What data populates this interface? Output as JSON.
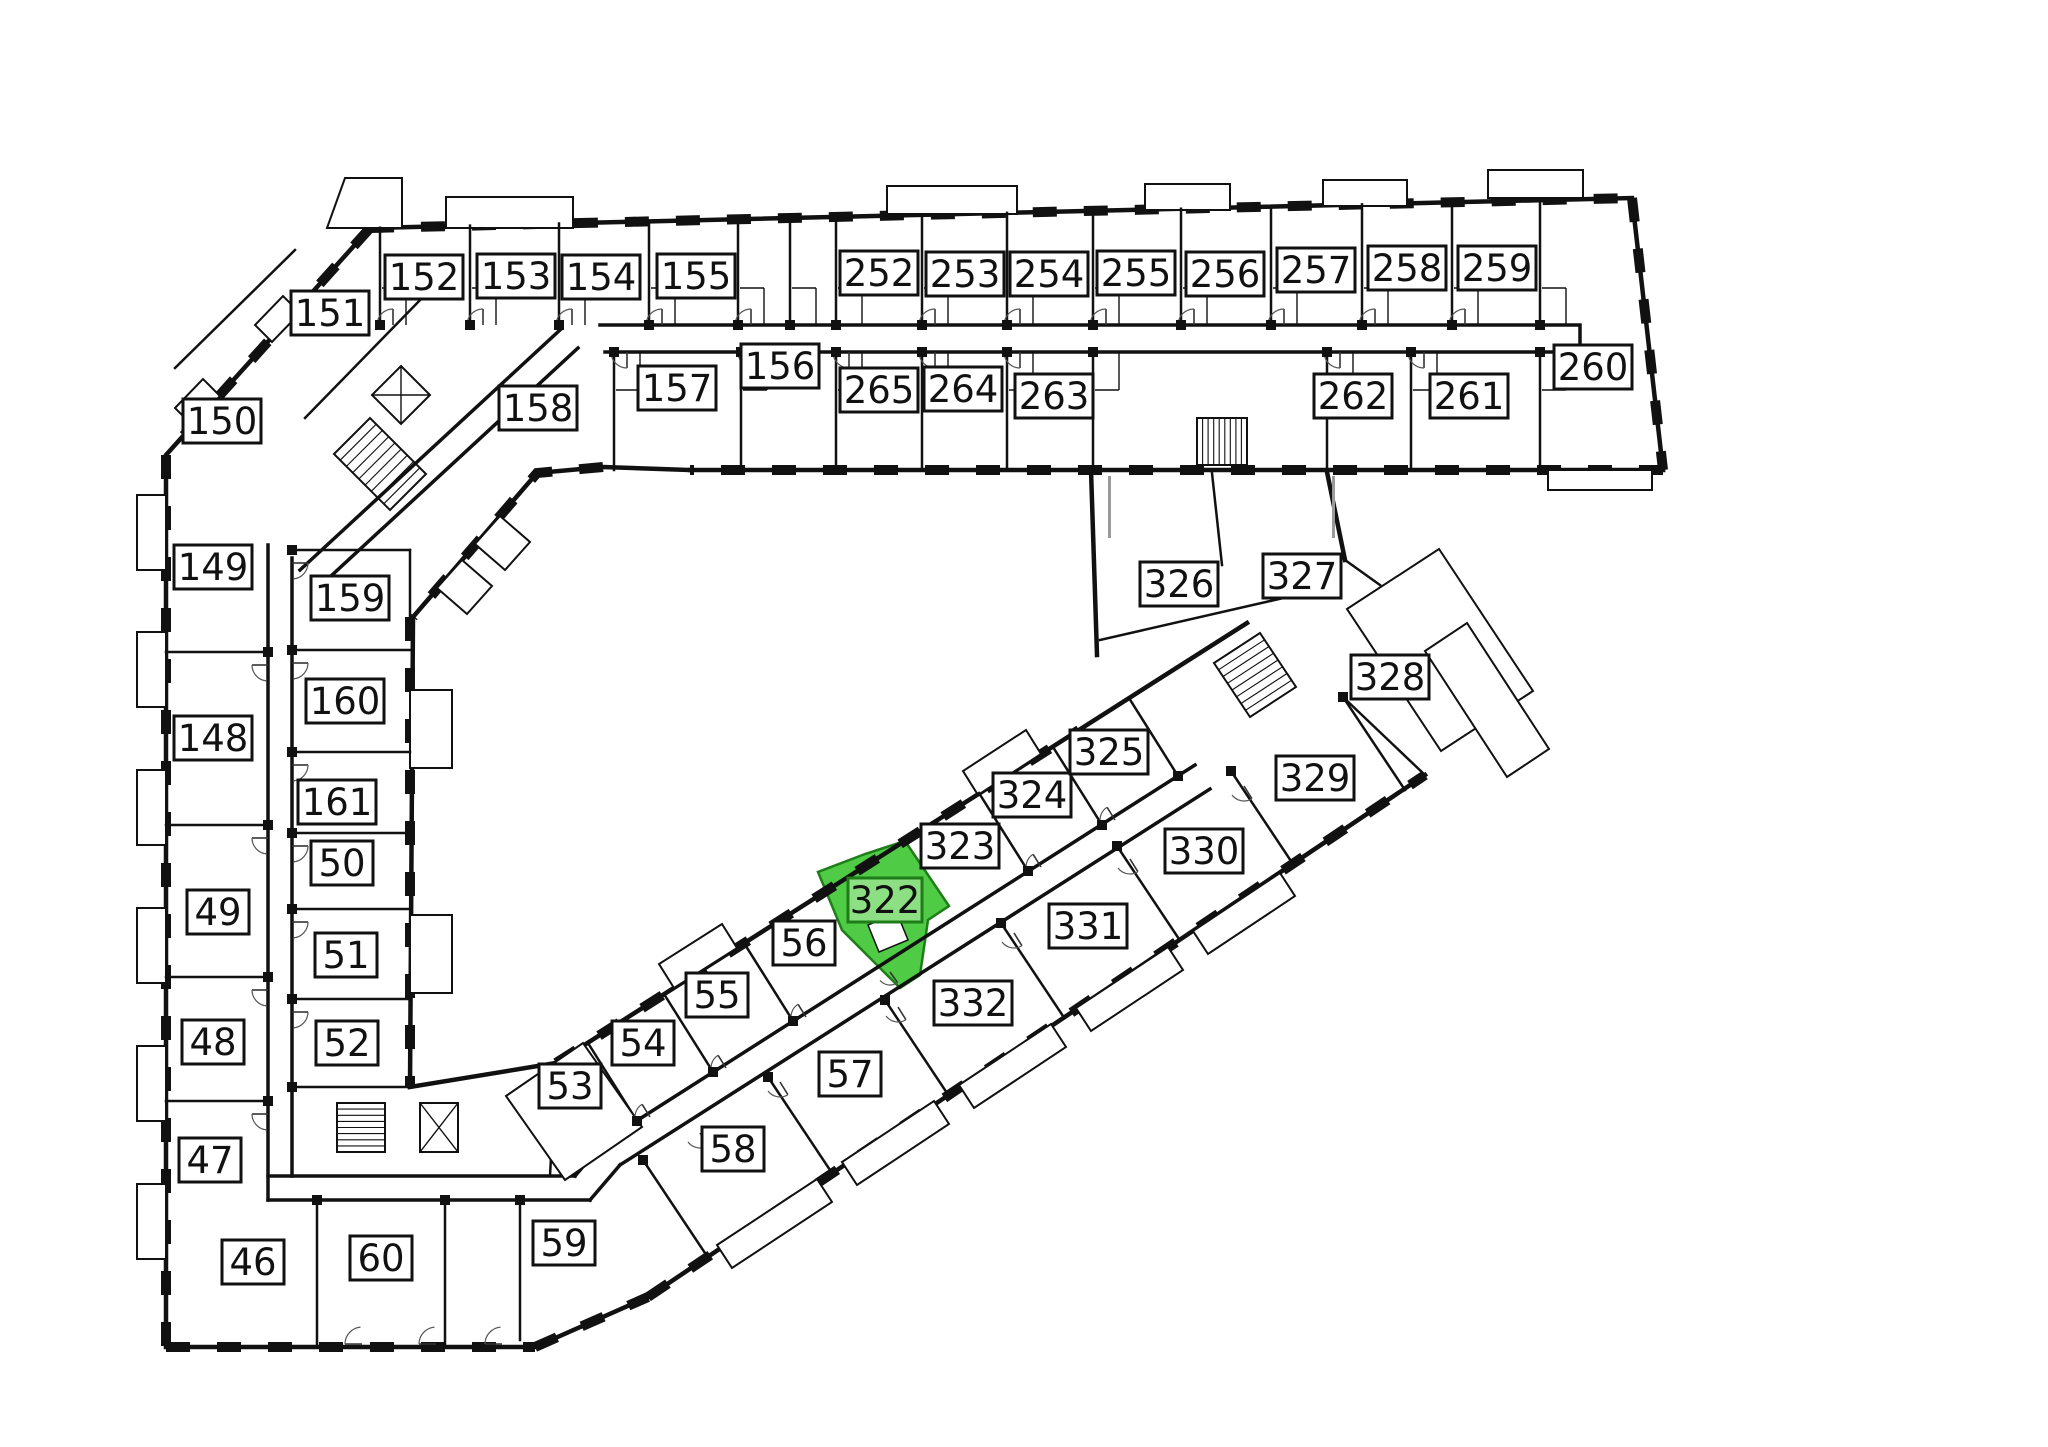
{
  "title": "Building floor plan with highlighted apartment",
  "highlighted_room": "322",
  "colors": {
    "wall": "#111111",
    "background": "#ffffff",
    "highlight_fill": "#4FCB46",
    "highlight_label_fill": "#8CDF82",
    "highlight_stroke": "#1F7D18",
    "highlight_text": "#1F7D18",
    "label_fill": "#ffffff",
    "label_stroke": "#111111",
    "label_text": "#111111"
  },
  "rooms": [
    {
      "id": "152",
      "x": 424,
      "y": 277
    },
    {
      "id": "153",
      "x": 516,
      "y": 276
    },
    {
      "id": "154",
      "x": 601,
      "y": 277
    },
    {
      "id": "155",
      "x": 696,
      "y": 276
    },
    {
      "id": "151",
      "x": 330,
      "y": 313
    },
    {
      "id": "150",
      "x": 222,
      "y": 421
    },
    {
      "id": "156",
      "x": 780,
      "y": 366
    },
    {
      "id": "157",
      "x": 677,
      "y": 388
    },
    {
      "id": "158",
      "x": 538,
      "y": 408
    },
    {
      "id": "149",
      "x": 213,
      "y": 567
    },
    {
      "id": "159",
      "x": 350,
      "y": 598
    },
    {
      "id": "160",
      "x": 345,
      "y": 701
    },
    {
      "id": "148",
      "x": 213,
      "y": 738
    },
    {
      "id": "161",
      "x": 337,
      "y": 802
    },
    {
      "id": "50",
      "x": 342,
      "y": 863
    },
    {
      "id": "49",
      "x": 218,
      "y": 912
    },
    {
      "id": "51",
      "x": 346,
      "y": 955
    },
    {
      "id": "48",
      "x": 213,
      "y": 1042
    },
    {
      "id": "52",
      "x": 347,
      "y": 1043
    },
    {
      "id": "47",
      "x": 210,
      "y": 1160
    },
    {
      "id": "46",
      "x": 253,
      "y": 1262
    },
    {
      "id": "60",
      "x": 381,
      "y": 1258
    },
    {
      "id": "59",
      "x": 564,
      "y": 1243
    },
    {
      "id": "53",
      "x": 570,
      "y": 1086
    },
    {
      "id": "54",
      "x": 643,
      "y": 1043
    },
    {
      "id": "55",
      "x": 717,
      "y": 995
    },
    {
      "id": "56",
      "x": 804,
      "y": 943
    },
    {
      "id": "322",
      "x": 885,
      "y": 900,
      "highlight": true
    },
    {
      "id": "323",
      "x": 960,
      "y": 846
    },
    {
      "id": "324",
      "x": 1032,
      "y": 795
    },
    {
      "id": "325",
      "x": 1109,
      "y": 752
    },
    {
      "id": "58",
      "x": 733,
      "y": 1149
    },
    {
      "id": "57",
      "x": 850,
      "y": 1074
    },
    {
      "id": "332",
      "x": 973,
      "y": 1003
    },
    {
      "id": "331",
      "x": 1088,
      "y": 926
    },
    {
      "id": "330",
      "x": 1204,
      "y": 851
    },
    {
      "id": "329",
      "x": 1315,
      "y": 778
    },
    {
      "id": "326",
      "x": 1179,
      "y": 584
    },
    {
      "id": "327",
      "x": 1302,
      "y": 576
    },
    {
      "id": "328",
      "x": 1390,
      "y": 677
    },
    {
      "id": "252",
      "x": 879,
      "y": 273
    },
    {
      "id": "253",
      "x": 965,
      "y": 274
    },
    {
      "id": "254",
      "x": 1049,
      "y": 274
    },
    {
      "id": "255",
      "x": 1136,
      "y": 273
    },
    {
      "id": "256",
      "x": 1225,
      "y": 274
    },
    {
      "id": "257",
      "x": 1316,
      "y": 270
    },
    {
      "id": "258",
      "x": 1407,
      "y": 268
    },
    {
      "id": "259",
      "x": 1497,
      "y": 268
    },
    {
      "id": "260",
      "x": 1593,
      "y": 367
    },
    {
      "id": "261",
      "x": 1469,
      "y": 396
    },
    {
      "id": "262",
      "x": 1353,
      "y": 396
    },
    {
      "id": "263",
      "x": 1054,
      "y": 396
    },
    {
      "id": "264",
      "x": 963,
      "y": 389
    },
    {
      "id": "265",
      "x": 879,
      "y": 390
    }
  ]
}
